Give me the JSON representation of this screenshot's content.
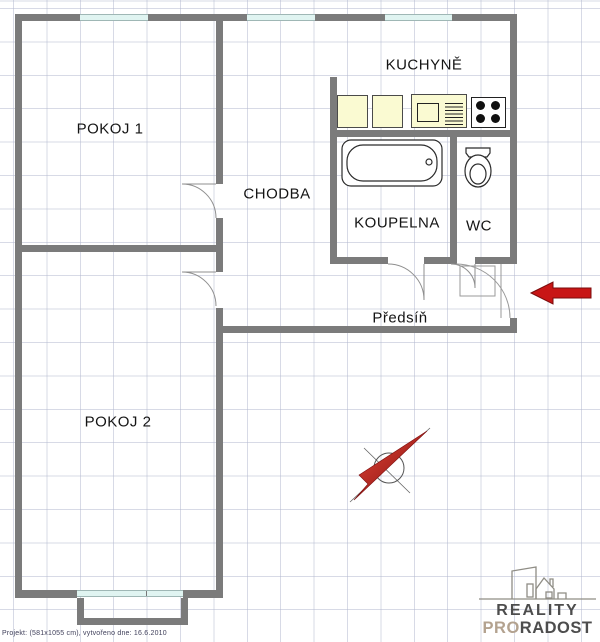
{
  "floorplan": {
    "rooms": {
      "pokoj1": "POKOJ 1",
      "kuchyne": "KUCHYNĚ",
      "chodba": "CHODBA",
      "koupelna": "KOUPELNA",
      "wc": "WC",
      "predsin": "Předsíň",
      "pokoj2": "POKOJ 2"
    },
    "footer_note": "Projekt:  (581x1055 cm), vytvořeno dne: 16.6.2010",
    "logo": {
      "line1": "REALITY",
      "line2_part1": "PRO",
      "line2_part2": "RADOST"
    },
    "colors": {
      "wall": "#7b7b7b",
      "window": "#e0f4f1",
      "cabinet_fill": "#fafad2",
      "entrance_arrow_red": "#c81616",
      "compass_red": "#b51212",
      "logo_dark": "#4d4d4d",
      "logo_tan": "#b3a28f"
    }
  }
}
